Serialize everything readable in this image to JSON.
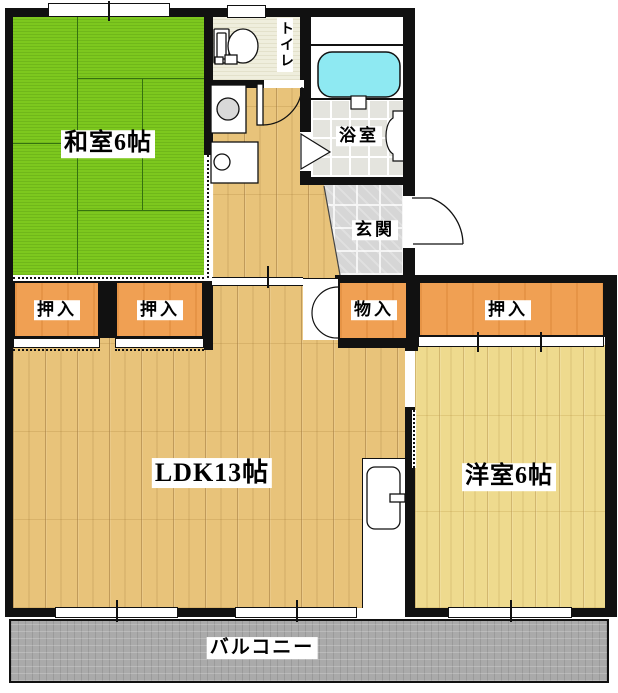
{
  "title": "apartment-floor-plan",
  "rooms": {
    "washitsu": {
      "label": "和室6帖"
    },
    "toilet": {
      "label": "トイレ"
    },
    "bath": {
      "label": "浴室"
    },
    "genkan": {
      "label": "玄関"
    },
    "ldk": {
      "label": "LDK13帖"
    },
    "yoshitsu": {
      "label": "洋室6帖"
    },
    "balcony": {
      "label": "バルコニー"
    },
    "closet_w1": {
      "label": "押入"
    },
    "closet_w2": {
      "label": "押入"
    },
    "storage": {
      "label": "物入"
    },
    "closet_e": {
      "label": "押入"
    }
  },
  "fixtures": {
    "toilet_bowl": "toilet-icon",
    "washing_machine": "washing-machine-icon",
    "washbasin": "washbasin-icon",
    "bathtub": "bathtub-icon",
    "refrigerator": "refrigerator-icon"
  },
  "colors": {
    "tatami": "#7dc81e",
    "wood_ldk": "#e8c37a",
    "wood_yoshitsu": "#eeda8e",
    "closet": "#f0a053",
    "bathtub": "#8ee9f2",
    "balcony": "#aaaaaa",
    "genkan_tile": "#d6d6d6",
    "wall": "#111111"
  }
}
